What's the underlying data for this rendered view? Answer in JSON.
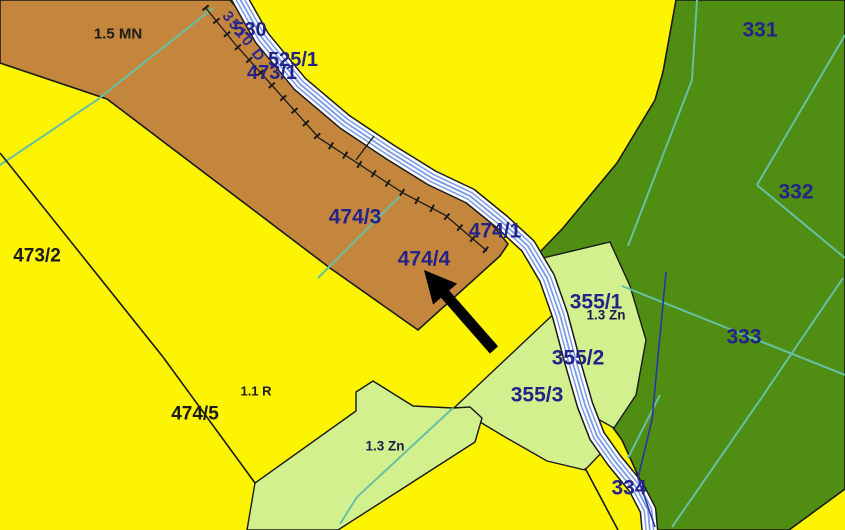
{
  "map": {
    "labels": {
      "area_1_5_mn": "1.5 MN",
      "parcel_530": "530",
      "watercourse_3510": "3510 D",
      "parcel_525_1": "525/1",
      "parcel_473_1": "473/1",
      "parcel_473_2": "473/2",
      "parcel_474_3": "474/3",
      "parcel_474_1": "474/1",
      "parcel_474_4": "474/4",
      "parcel_474_5": "474/5",
      "area_1_1_r": "1.1 R",
      "area_1_3_zn_south": "1.3 Zn",
      "area_1_3_zn_east": "1.3 Zn",
      "parcel_355_1": "355/1",
      "parcel_355_2": "355/2",
      "parcel_355_3": "355/3",
      "parcel_331": "331",
      "parcel_332": "332",
      "parcel_333": "333",
      "parcel_334": "334"
    },
    "colors": {
      "field_yellow": "#FCF400",
      "arable_brown": "#C4863C",
      "forest_green": "#4F8D13",
      "meadow_light_green": "#D2F18E",
      "water_blue": "#7B9AE8",
      "boundary_teal": "#66C0A3",
      "parcel_number_navy": "#232388",
      "annotation_black": "#000000"
    }
  }
}
